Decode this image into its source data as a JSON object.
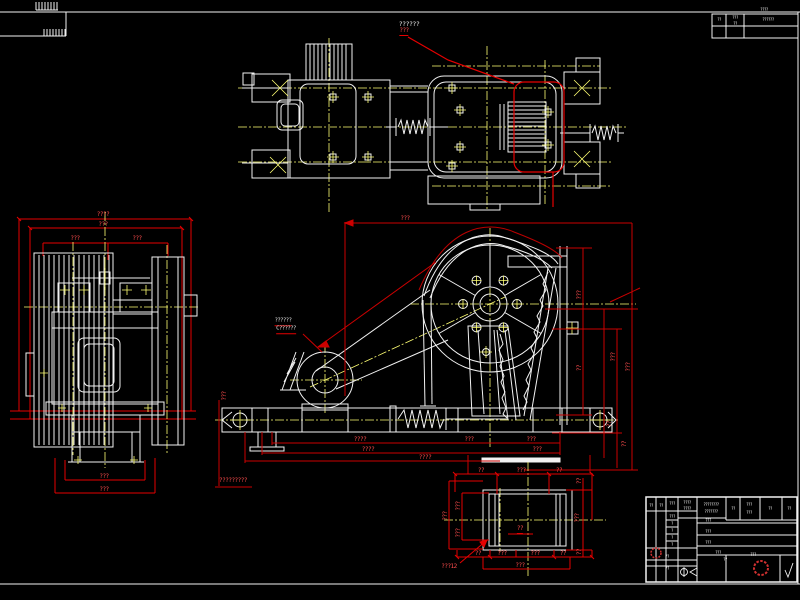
{
  "colors": {
    "background": "#000000",
    "geometry": "#f2f2f2",
    "centerline": "#ffff73",
    "dimension_line": "#e60000",
    "dimension_text_red": "#ff4d4d",
    "text_white": "#e9e9e9",
    "stamp_red": "#d03030"
  },
  "sheet": {
    "top_label_white": "??????",
    "top_label_red": "???"
  },
  "annotations": {
    "sheet_labels": [
      {
        "t": "??????",
        "x": 409,
        "y": 24,
        "c": "white",
        "s": 6.5
      },
      {
        "t": "???",
        "x": 404,
        "y": 32,
        "ul": 1
      }
    ],
    "side_view": [
      {
        "t": "????",
        "x": 103,
        "y": 215
      },
      {
        "t": "???",
        "x": 103,
        "y": 225
      },
      {
        "t": "???",
        "x": 75,
        "y": 239
      },
      {
        "t": "???",
        "x": 137,
        "y": 239
      },
      {
        "t": "???",
        "x": 104,
        "y": 477
      },
      {
        "t": "???",
        "x": 104,
        "y": 490
      }
    ],
    "front_view": [
      {
        "t": "???",
        "x": 405,
        "y": 219
      },
      {
        "t": "???",
        "x": 225,
        "y": 396,
        "r": 1
      },
      {
        "t": "??????",
        "x": 283,
        "y": 322,
        "c": "white",
        "s": 5.5,
        "ul": 1
      },
      {
        "t": "C??????",
        "x": 286,
        "y": 330,
        "c": "white",
        "s": 5.5,
        "ul": 1
      },
      {
        "t": "????",
        "x": 360,
        "y": 440
      },
      {
        "t": "????",
        "x": 368,
        "y": 450
      },
      {
        "t": "????",
        "x": 425,
        "y": 458
      },
      {
        "t": "???",
        "x": 469,
        "y": 440
      },
      {
        "t": "???",
        "x": 531,
        "y": 440
      },
      {
        "t": "???",
        "x": 537,
        "y": 450
      },
      {
        "t": "?????????",
        "x": 233,
        "y": 481
      },
      {
        "t": "???",
        "x": 580,
        "y": 295,
        "r": 1
      },
      {
        "t": "??",
        "x": 580,
        "y": 368,
        "r": 1
      },
      {
        "t": "???",
        "x": 614,
        "y": 357,
        "r": 1
      },
      {
        "t": "???",
        "x": 629,
        "y": 367,
        "r": 1
      },
      {
        "t": "??",
        "x": 610,
        "y": 424,
        "r": 1
      },
      {
        "t": "??",
        "x": 625,
        "y": 444,
        "r": 1
      }
    ],
    "detail_view": [
      {
        "t": "??",
        "x": 481,
        "y": 471
      },
      {
        "t": "???",
        "x": 521,
        "y": 471
      },
      {
        "t": "??",
        "x": 559,
        "y": 471
      },
      {
        "t": "???",
        "x": 446,
        "y": 516,
        "r": 1
      },
      {
        "t": "???",
        "x": 459,
        "y": 506,
        "r": 1
      },
      {
        "t": "???",
        "x": 459,
        "y": 533,
        "r": 1
      },
      {
        "t": "??",
        "x": 520,
        "y": 530,
        "ul": 1
      },
      {
        "t": "??",
        "x": 478,
        "y": 554
      },
      {
        "t": "???",
        "x": 502,
        "y": 554
      },
      {
        "t": "???",
        "x": 535,
        "y": 554
      },
      {
        "t": "??",
        "x": 563,
        "y": 554
      },
      {
        "t": "???",
        "x": 520,
        "y": 566
      },
      {
        "t": "??",
        "x": 580,
        "y": 481,
        "r": 1
      },
      {
        "t": "???",
        "x": 578,
        "y": 518,
        "r": 1
      },
      {
        "t": "??",
        "x": 580,
        "y": 552,
        "r": 1
      },
      {
        "t": "???12",
        "x": 449,
        "y": 567
      }
    ]
  },
  "rev_table": {
    "cells": [
      {
        "t": "????",
        "x": 764,
        "y": 10,
        "c": "white",
        "s": 4
      },
      {
        "t": "??",
        "x": 719,
        "y": 20,
        "c": "white",
        "s": 4
      },
      {
        "t": "???",
        "x": 735,
        "y": 18,
        "c": "white",
        "s": 4
      },
      {
        "t": "??",
        "x": 735,
        "y": 24,
        "c": "white",
        "s": 4
      },
      {
        "t": "??????",
        "x": 768,
        "y": 20,
        "c": "white",
        "s": 4
      }
    ]
  },
  "title_block": {
    "cells": [
      {
        "t": "??",
        "x": 651,
        "y": 506,
        "c": "white",
        "s": 4
      },
      {
        "t": "??",
        "x": 661,
        "y": 506,
        "c": "white",
        "s": 4
      },
      {
        "t": "???",
        "x": 672,
        "y": 504,
        "c": "white",
        "s": 4
      },
      {
        "t": "????",
        "x": 687,
        "y": 503,
        "c": "white",
        "s": 4
      },
      {
        "t": "????",
        "x": 687,
        "y": 509,
        "c": "white",
        "s": 4
      },
      {
        "t": "???",
        "x": 672,
        "y": 517,
        "c": "white",
        "s": 4
      },
      {
        "t": "?",
        "x": 672,
        "y": 524,
        "c": "white",
        "s": 4
      },
      {
        "t": "?",
        "x": 672,
        "y": 531,
        "c": "white",
        "s": 4
      },
      {
        "t": "?",
        "x": 672,
        "y": 538,
        "c": "white",
        "s": 4
      },
      {
        "t": "?",
        "x": 672,
        "y": 545,
        "c": "white",
        "s": 4
      },
      {
        "t": "??",
        "x": 667,
        "y": 557,
        "c": "white",
        "s": 4
      },
      {
        "t": "??",
        "x": 667,
        "y": 569,
        "c": "white",
        "s": 4
      },
      {
        "t": "????????",
        "x": 711,
        "y": 505,
        "c": "white",
        "s": 4
      },
      {
        "t": "???????",
        "x": 711,
        "y": 512,
        "c": "white",
        "s": 4
      },
      {
        "t": "???",
        "x": 708,
        "y": 521,
        "c": "white",
        "s": 4
      },
      {
        "t": "???",
        "x": 708,
        "y": 532,
        "c": "white",
        "s": 4
      },
      {
        "t": "???",
        "x": 708,
        "y": 543,
        "c": "white",
        "s": 4
      },
      {
        "t": "???",
        "x": 718,
        "y": 553,
        "c": "white",
        "s": 4
      },
      {
        "t": "??",
        "x": 725,
        "y": 560,
        "c": "white",
        "s": 4
      },
      {
        "t": "???",
        "x": 753,
        "y": 555,
        "c": "white",
        "s": 4
      },
      {
        "t": "??",
        "x": 733,
        "y": 509,
        "c": "white",
        "s": 4
      },
      {
        "t": "???",
        "x": 749,
        "y": 505,
        "c": "white",
        "s": 4
      },
      {
        "t": "???",
        "x": 749,
        "y": 513,
        "c": "white",
        "s": 4
      },
      {
        "t": "??",
        "x": 770,
        "y": 509,
        "c": "white",
        "s": 4
      },
      {
        "t": "??",
        "x": 789,
        "y": 509,
        "c": "white",
        "s": 4
      }
    ]
  }
}
